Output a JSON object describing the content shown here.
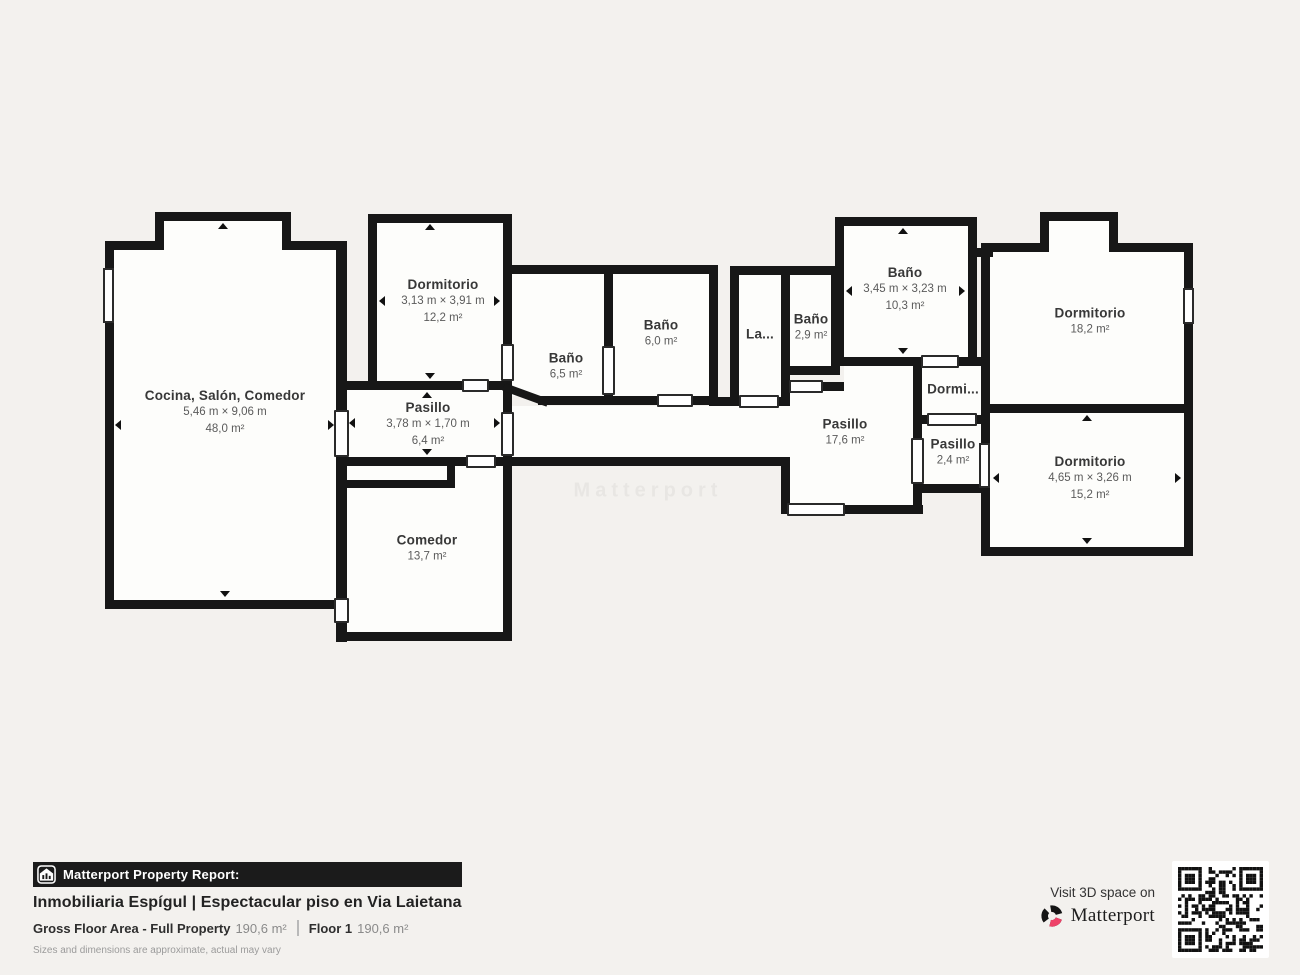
{
  "page": {
    "background": "#f3f1ee"
  },
  "colors": {
    "wall": "#171717",
    "floor": "#fdfdfb",
    "brand_pink": "#ee4268",
    "bar_black": "#1b1b1b"
  },
  "plan": {
    "watermark": "Matterport",
    "rooms": {
      "cocina": {
        "name": "Cocina, Salón, Comedor",
        "dims": "5,46 m × 9,06 m",
        "area": "48,0 m²"
      },
      "dormitorio_12": {
        "name": "Dormitorio",
        "dims": "3,13 m × 3,91 m",
        "area": "12,2 m²"
      },
      "pasillo_6": {
        "name": "Pasillo",
        "dims": "3,78 m × 1,70 m",
        "area": "6,4 m²"
      },
      "comedor": {
        "name": "Comedor",
        "area": "13,7 m²"
      },
      "bano_6_5": {
        "name": "Baño",
        "area": "6,5 m²"
      },
      "bano_6_0": {
        "name": "Baño",
        "area": "6,0 m²"
      },
      "lavadero": {
        "name": "La..."
      },
      "bano_2_9": {
        "name": "Baño",
        "area": "2,9 m²"
      },
      "bano_10_3": {
        "name": "Baño",
        "dims": "3,45 m × 3,23 m",
        "area": "10,3 m²"
      },
      "dormitorio_18": {
        "name": "Dormitorio",
        "area": "18,2 m²"
      },
      "dormi": {
        "name": "Dormi..."
      },
      "pasillo_2_4": {
        "name": "Pasillo",
        "area": "2,4 m²"
      },
      "dormitorio_15": {
        "name": "Dormitorio",
        "dims": "4,65 m × 3,26 m",
        "area": "15,2 m²"
      },
      "pasillo_17": {
        "name": "Pasillo",
        "area": "17,6 m²"
      }
    }
  },
  "footer": {
    "report_label": "Matterport Property Report:",
    "title": "Inmobiliaria Espígul | Espectacular piso en Via Laietana",
    "gross_label": "Gross Floor Area - Full Property",
    "gross_value": "190,6 m²",
    "floor_label": "Floor 1",
    "floor_value": "190,6 m²",
    "disclaimer": "Sizes and dimensions are approximate, actual may vary",
    "visit_label": "Visit 3D space on",
    "brand": "Matterport"
  }
}
